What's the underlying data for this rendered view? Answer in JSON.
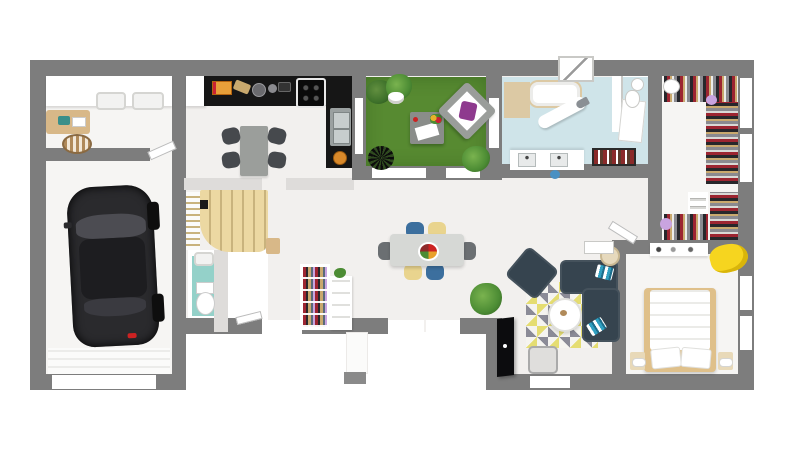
{
  "scene": {
    "description": "3D rendered top-down floor plan of a single-storey house viewed from above on a white background",
    "canvas": {
      "width": 800,
      "height": 450
    },
    "background": "#ffffff"
  },
  "colors": {
    "background": "#ffffff",
    "wall": "#7d7d7d",
    "wall_light": "#dedcda",
    "floor_main": "#f2f0ee",
    "floor_light": "#f6f5f3",
    "grass": "#578a31",
    "bath_floor": "#cfe4e9",
    "wc_floor": "#94d1c9",
    "stairs_wood": "#ecd8a2",
    "stairs_edge": "#c9b37d",
    "counter_black": "#161616",
    "car_black": "#2a2a2d",
    "glass_gray": "#4c4c52",
    "sofa_navy": "#36444f",
    "stripe_blue": "#2f9fc0",
    "chair_blue": "#3c6f9e",
    "chair_yellow": "#e9d48e",
    "chair_dark": "#46494d",
    "table_gray": "#d6d8d5",
    "rug_yellow": "#e5dd72",
    "rug_gray": "#8b8b97",
    "rug_white": "#f5f4f0",
    "bed_wood": "#dfc08a",
    "blanket_yellow": "#f6d51f",
    "plant_green": "#4c8c34",
    "plant_dark": "#2f5a1f",
    "shelf_wood": "#d8b888",
    "clothes_red": "#9c2531",
    "clothes_dark": "#27272b",
    "clothes_tan": "#c9a96e",
    "purple": "#c9a4e0",
    "pillow_purple": "#8e3a8e",
    "white": "#ffffff",
    "appliance_gray": "#9aa0a0",
    "towel_red": "#8a2a2a"
  },
  "rooms": [
    {
      "id": "utility-room"
    },
    {
      "id": "garage"
    },
    {
      "id": "kitchen-dining"
    },
    {
      "id": "stair-hall"
    },
    {
      "id": "wc"
    },
    {
      "id": "terrace"
    },
    {
      "id": "bathroom"
    },
    {
      "id": "dressing-room"
    },
    {
      "id": "bedroom"
    },
    {
      "id": "living-room"
    }
  ],
  "furniture": [
    "black-car",
    "washer-dryer",
    "storage-basket",
    "wood-shelf",
    "kitchen-counter",
    "cooktop",
    "kitchen-sink",
    "kitchen-table",
    "kitchen-chairs",
    "staircase",
    "wc-toilet",
    "wc-sink",
    "bookshelf",
    "dining-table",
    "dining-chairs",
    "fruit-bowl",
    "indoor-plant",
    "outdoor-lounge-chair",
    "outdoor-table",
    "terrace-plants",
    "bathtub",
    "shower",
    "ironing-board",
    "double-sink-vanity",
    "towel-shelf",
    "toilet",
    "clothes-racks",
    "folded-clothes-shelf",
    "double-bed",
    "nightstands",
    "dresser",
    "yellow-blanket",
    "corner-sofa",
    "armchair",
    "coffee-table",
    "geometric-rug",
    "tv-panel",
    "floor-lamp",
    "side-table"
  ]
}
